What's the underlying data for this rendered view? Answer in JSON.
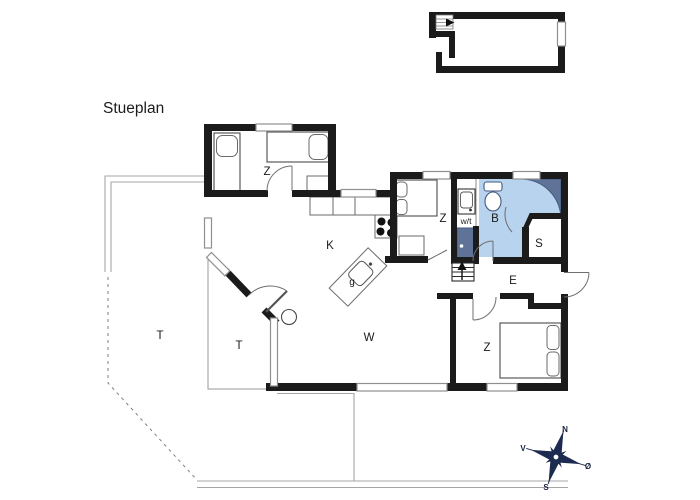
{
  "title": "Stueplan",
  "rooms": [
    {
      "key": "bedroom-top-left",
      "label": "Z"
    },
    {
      "key": "bedroom-middle",
      "label": "Z"
    },
    {
      "key": "bedroom-bottom",
      "label": "Z"
    },
    {
      "key": "kitchen",
      "label": "K"
    },
    {
      "key": "living-room",
      "label": "W"
    },
    {
      "key": "bathroom",
      "label": "B"
    },
    {
      "key": "sauna",
      "label": "S"
    },
    {
      "key": "entrance-hall",
      "label": "E"
    },
    {
      "key": "terrace-left",
      "label": "T"
    },
    {
      "key": "terrace-inner",
      "label": "T"
    },
    {
      "key": "utility-washer-dryer",
      "label": "w/t"
    },
    {
      "key": "kitchen-sink-unit",
      "label": "g"
    }
  ],
  "compass": {
    "north": "N",
    "south": "S",
    "east": "Ø",
    "west": "V"
  },
  "colors": {
    "wall": "#1b1b1b",
    "bath_light": "#b7d3ed",
    "bath_dark": "#5f7399",
    "fixture_stroke": "#44597e",
    "compass_navy": "#1c2b4f",
    "window_stroke": "#8f8f8f",
    "terrace_line": "#a5a5a5"
  }
}
